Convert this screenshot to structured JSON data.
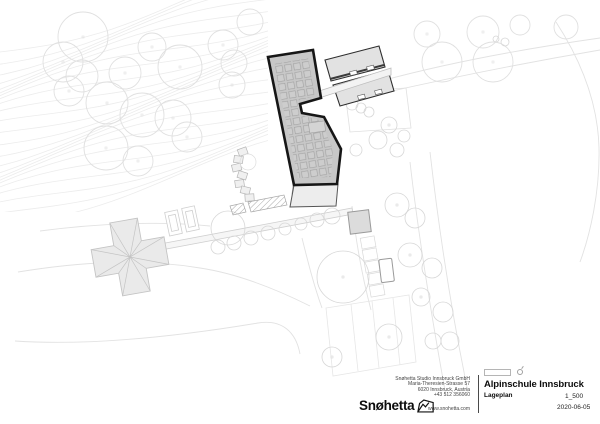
{
  "title_block": {
    "project": "Alpinschule Innsbruck",
    "drawing": "Lageplan",
    "scale": "1_500",
    "date": "2020-06-05",
    "firm": "Snøhetta",
    "address_lines": [
      "Snøhetta Studio Innsbruck GmbH",
      "Maria-Theresien-Strasse 57",
      "6020 Innsbruck, Austria",
      "+43 512 356060"
    ],
    "website": "www.snohetta.com"
  },
  "colors": {
    "background": "#ffffff",
    "contour": "#ececec",
    "road": "#e2e2e2",
    "tree": "#dfdfdf",
    "tree_small": "#d7d7d7",
    "light_fill": "#eaeaea",
    "light_stroke": "#c4c4c4",
    "roof_fill": "#c7c7c7",
    "outline_dark": "#161616",
    "barn_fill": "#e2e2e2",
    "gray": "#9a9a9a"
  },
  "plan": {
    "layers": [
      {
        "name": "contours",
        "stroke": "#ececec",
        "width": 0.8,
        "generator": {
          "count": 24,
          "spacing": 7.5,
          "base_y": 52,
          "slope": -0.28,
          "amp": 9,
          "wavelength": 58,
          "phase": 0.55,
          "x0": -20,
          "x1": 300,
          "step": 12
        }
      },
      {
        "name": "roads",
        "stroke": "#e2e2e2",
        "fill": "none",
        "width": 0.9,
        "items": [
          {
            "shape": "path",
            "d": "M340,93 C400,74 480,55 600,38"
          },
          {
            "shape": "path",
            "d": "M340,103 C420,84 500,67 600,50"
          },
          {
            "shape": "path",
            "d": "M556,22 C582,62 598,105 599,148 C600,192 590,235 580,262"
          },
          {
            "shape": "path",
            "d": "M430,152 C438,222 450,305 468,392"
          },
          {
            "shape": "path",
            "d": "M410,162 C418,232 430,308 446,396"
          },
          {
            "shape": "path",
            "d": "M18,272 C80,262 140,258 200,268 C240,274 282,292 310,306"
          },
          {
            "shape": "path",
            "d": "M15,341 C90,346 180,336 258,323 C282,319 296,332 300,354"
          },
          {
            "shape": "path",
            "d": "M302,238 C308,262 314,286 322,308"
          },
          {
            "shape": "path",
            "d": "M40,231 C100,223 160,221 210,226"
          },
          {
            "shape": "path",
            "d": "M352,206 C356,242 362,276 371,310"
          }
        ]
      },
      {
        "name": "parcel",
        "stroke": "#e6e6e6",
        "fill": "none",
        "width": 0.8,
        "items": [
          {
            "shape": "polygon",
            "points": "326,308 409,295 416,362 333,376"
          },
          {
            "shape": "line",
            "x1": 351,
            "y1": 304,
            "x2": 358,
            "y2": 371
          },
          {
            "shape": "line",
            "x1": 372,
            "y1": 301,
            "x2": 379,
            "y2": 368
          },
          {
            "shape": "line",
            "x1": 393,
            "y1": 298,
            "x2": 400,
            "y2": 365
          }
        ]
      },
      {
        "name": "trees-large",
        "stroke": "#e0e0e0",
        "fill": "none",
        "width": 0.9,
        "items": [
          {
            "shape": "circle",
            "x": 83,
            "y": 37,
            "r": 25,
            "dot": true
          },
          {
            "shape": "circle",
            "x": 63,
            "y": 62,
            "r": 20,
            "dot": true
          },
          {
            "shape": "circle",
            "x": 82,
            "y": 76,
            "r": 16
          },
          {
            "shape": "circle",
            "x": 69,
            "y": 91,
            "r": 15,
            "dot": true
          },
          {
            "shape": "circle",
            "x": 125,
            "y": 73,
            "r": 16,
            "dot": true
          },
          {
            "shape": "circle",
            "x": 107,
            "y": 103,
            "r": 21,
            "dot": true
          },
          {
            "shape": "circle",
            "x": 152,
            "y": 47,
            "r": 14,
            "dot": true
          },
          {
            "shape": "circle",
            "x": 180,
            "y": 67,
            "r": 22,
            "dot": true
          },
          {
            "shape": "circle",
            "x": 223,
            "y": 45,
            "r": 15,
            "dot": true
          },
          {
            "shape": "circle",
            "x": 234,
            "y": 63,
            "r": 13
          },
          {
            "shape": "circle",
            "x": 232,
            "y": 85,
            "r": 13,
            "dot": true
          },
          {
            "shape": "circle",
            "x": 142,
            "y": 115,
            "r": 22,
            "dot": true
          },
          {
            "shape": "circle",
            "x": 173,
            "y": 118,
            "r": 18,
            "dot": true
          },
          {
            "shape": "circle",
            "x": 187,
            "y": 137,
            "r": 15,
            "dot": true
          },
          {
            "shape": "circle",
            "x": 106,
            "y": 148,
            "r": 22,
            "dot": true
          },
          {
            "shape": "circle",
            "x": 138,
            "y": 161,
            "r": 15,
            "dot": true
          },
          {
            "shape": "circle",
            "x": 250,
            "y": 22,
            "r": 13
          },
          {
            "shape": "circle",
            "x": 427,
            "y": 34,
            "r": 13,
            "dot": true
          },
          {
            "shape": "circle",
            "x": 442,
            "y": 62,
            "r": 20,
            "dot": true
          },
          {
            "shape": "circle",
            "x": 483,
            "y": 32,
            "r": 16,
            "dot": true
          },
          {
            "shape": "circle",
            "x": 493,
            "y": 62,
            "r": 20,
            "dot": true
          },
          {
            "shape": "circle",
            "x": 520,
            "y": 25,
            "r": 10
          },
          {
            "shape": "circle",
            "x": 566,
            "y": 27,
            "r": 12
          }
        ]
      },
      {
        "name": "path-strip",
        "stroke": "#cfcfcf",
        "fill": "#f6f6f6",
        "width": 0.8,
        "items": [
          {
            "shape": "polygon",
            "points": "160,244 352,208 353,214 161,250"
          }
        ]
      },
      {
        "name": "chalet",
        "stroke": "#c4c4c4",
        "fill": "#eaeaea",
        "width": 0.9,
        "items": [
          {
            "shape": "polygon",
            "transform": "translate(130,257) rotate(-10)",
            "points": "-37,-14 -14,-14 -14,-37 14,-37 14,-14 37,-14 37,14 14,14 14,37 -14,37 -14,14 -37,14"
          },
          {
            "shape": "path",
            "transform": "translate(130,257) rotate(-10)",
            "fill": "none",
            "width": 0.7,
            "d": "M-37,-14L0,0L-14,-37M14,-37L0,0L37,-14M37,14L0,0L14,37M-14,37L0,0L-37,14M-14,-14L0,0L14,-14M14,14L0,0L-14,14"
          }
        ]
      },
      {
        "name": "drive-pads",
        "stroke": "#cfcfcf",
        "fill": "#ffffff",
        "width": 0.8,
        "items": [
          {
            "shape": "rect",
            "x": 167,
            "y": 211,
            "w": 13,
            "h": 24,
            "transform": "rotate(-12 173 223)"
          },
          {
            "shape": "rect",
            "x": 170,
            "y": 215,
            "w": 7,
            "h": 16,
            "fill": "none",
            "transform": "rotate(-12 173 223)"
          },
          {
            "shape": "rect",
            "x": 184,
            "y": 207,
            "w": 13,
            "h": 24,
            "transform": "rotate(-12 190 219)"
          },
          {
            "shape": "rect",
            "x": 187,
            "y": 211,
            "w": 7,
            "h": 16,
            "fill": "none",
            "transform": "rotate(-12 190 219)"
          }
        ]
      },
      {
        "name": "steps",
        "stroke": "#b5b5b5",
        "fill": "#f0f0f0",
        "width": 0.7,
        "items": [
          {
            "shape": "rect",
            "x": 238,
            "y": 148,
            "w": 9,
            "h": 7,
            "transform": "rotate(-20 243 151)"
          },
          {
            "shape": "rect",
            "x": 234,
            "y": 156,
            "w": 9,
            "h": 7,
            "transform": "rotate(8 239 159)"
          },
          {
            "shape": "rect",
            "x": 232,
            "y": 164,
            "w": 9,
            "h": 7,
            "transform": "rotate(-14 237 167)"
          },
          {
            "shape": "rect",
            "x": 238,
            "y": 172,
            "w": 9,
            "h": 7,
            "transform": "rotate(18 243 175)"
          },
          {
            "shape": "rect",
            "x": 235,
            "y": 180,
            "w": 9,
            "h": 7,
            "transform": "rotate(-8 240 183)"
          },
          {
            "shape": "rect",
            "x": 241,
            "y": 187,
            "w": 9,
            "h": 7,
            "transform": "rotate(14 246 190)"
          },
          {
            "shape": "rect",
            "x": 245,
            "y": 194,
            "w": 9,
            "h": 7,
            "transform": "rotate(-4 250 197)"
          },
          {
            "shape": "circle",
            "x": 248,
            "y": 162,
            "r": 8,
            "fill": "none",
            "stroke": "#dddddd"
          }
        ]
      },
      {
        "name": "stalls",
        "stroke": "#d8d8d8",
        "fill": "none",
        "width": 0.7,
        "items": [
          {
            "shape": "rect",
            "x": 361,
            "y": 237,
            "w": 14,
            "h": 11,
            "transform": "rotate(-10 368 242)"
          },
          {
            "shape": "rect",
            "x": 363,
            "y": 249,
            "w": 14,
            "h": 11,
            "transform": "rotate(-10 370 254)"
          },
          {
            "shape": "rect",
            "x": 365,
            "y": 261,
            "w": 14,
            "h": 11,
            "transform": "rotate(-10 372 266)"
          },
          {
            "shape": "rect",
            "x": 368,
            "y": 273,
            "w": 14,
            "h": 11,
            "transform": "rotate(-10 375 278)"
          },
          {
            "shape": "rect",
            "x": 370,
            "y": 285,
            "w": 14,
            "h": 11,
            "transform": "rotate(-10 377 290)"
          }
        ]
      },
      {
        "name": "outbuildings",
        "stroke": "#9a9a9a",
        "fill": "#dcdcdc",
        "width": 1,
        "items": [
          {
            "shape": "rect",
            "x": 349,
            "y": 211,
            "w": 21,
            "h": 22,
            "transform": "rotate(-7 359 222)"
          },
          {
            "shape": "rect",
            "x": 380,
            "y": 259,
            "w": 13,
            "h": 23,
            "rx": 1.5,
            "fill": "#ffffff",
            "transform": "rotate(-7 386 270)"
          },
          {
            "shape": "polygon",
            "points": "345,92 406,88 411,128 350,132",
            "fill": "none",
            "stroke": "#e0e0e0",
            "width": 0.8
          }
        ]
      },
      {
        "name": "trees-small",
        "stroke": "#d7d7d7",
        "fill": "none",
        "width": 0.8,
        "items": [
          {
            "shape": "circle",
            "x": 218,
            "y": 247,
            "r": 7
          },
          {
            "shape": "circle",
            "x": 234,
            "y": 243,
            "r": 7
          },
          {
            "shape": "circle",
            "x": 251,
            "y": 238,
            "r": 7
          },
          {
            "shape": "circle",
            "x": 268,
            "y": 233,
            "r": 7
          },
          {
            "shape": "circle",
            "x": 285,
            "y": 229,
            "r": 6
          },
          {
            "shape": "circle",
            "x": 301,
            "y": 224,
            "r": 6
          },
          {
            "shape": "circle",
            "x": 317,
            "y": 220,
            "r": 7
          },
          {
            "shape": "circle",
            "x": 332,
            "y": 216,
            "r": 8
          },
          {
            "shape": "circle",
            "x": 228,
            "y": 228,
            "r": 17
          },
          {
            "shape": "circle",
            "x": 397,
            "y": 205,
            "r": 12,
            "dot": true
          },
          {
            "shape": "circle",
            "x": 415,
            "y": 218,
            "r": 10
          },
          {
            "shape": "circle",
            "x": 410,
            "y": 255,
            "r": 12,
            "dot": true
          },
          {
            "shape": "circle",
            "x": 432,
            "y": 268,
            "r": 10
          },
          {
            "shape": "circle",
            "x": 421,
            "y": 297,
            "r": 9,
            "dot": true
          },
          {
            "shape": "circle",
            "x": 443,
            "y": 312,
            "r": 10
          },
          {
            "shape": "circle",
            "x": 433,
            "y": 341,
            "r": 8
          },
          {
            "shape": "circle",
            "x": 450,
            "y": 341,
            "r": 9
          },
          {
            "shape": "circle",
            "x": 389,
            "y": 337,
            "r": 13,
            "dot": true
          },
          {
            "shape": "circle",
            "x": 332,
            "y": 357,
            "r": 10,
            "dot": true
          },
          {
            "shape": "circle",
            "x": 343,
            "y": 277,
            "r": 26,
            "dot": true
          },
          {
            "shape": "circle",
            "x": 352,
            "y": 104,
            "r": 6
          },
          {
            "shape": "circle",
            "x": 361,
            "y": 108,
            "r": 5
          },
          {
            "shape": "circle",
            "x": 369,
            "y": 112,
            "r": 5
          },
          {
            "shape": "circle",
            "x": 389,
            "y": 125,
            "r": 8,
            "dot": true
          },
          {
            "shape": "circle",
            "x": 378,
            "y": 140,
            "r": 9
          },
          {
            "shape": "circle",
            "x": 397,
            "y": 150,
            "r": 7
          },
          {
            "shape": "circle",
            "x": 356,
            "y": 150,
            "r": 6
          },
          {
            "shape": "circle",
            "x": 404,
            "y": 136,
            "r": 6
          },
          {
            "shape": "circle",
            "x": 505,
            "y": 42,
            "r": 4
          },
          {
            "shape": "circle",
            "x": 496,
            "y": 39,
            "r": 3
          }
        ]
      },
      {
        "name": "hatch-strips",
        "stroke": "#a8a8a8",
        "fill": "url(#hatch)",
        "width": 0.7,
        "items": [
          {
            "shape": "polygon",
            "points": "248,202 284,195 287,205 251,212"
          },
          {
            "shape": "polygon",
            "points": "230,206 243,203 246,212 233,215"
          },
          {
            "shape": "polygon",
            "points": "293,186 337,185 336,193 292,194"
          }
        ]
      },
      {
        "name": "barns",
        "stroke": "#2e2e2e",
        "fill": "#e2e2e2",
        "width": 1.1,
        "items": [
          {
            "shape": "polygon",
            "points": "325,60 379,46 385,67 331,81"
          },
          {
            "shape": "polygon",
            "points": "333,85 388,70 394,91 340,106"
          },
          {
            "shape": "line",
            "x1": 330,
            "y1": 79,
            "x2": 384,
            "y2": 65,
            "width": 2,
            "stroke": "#3a3a3a"
          },
          {
            "shape": "line",
            "x1": 336,
            "y1": 89,
            "x2": 390,
            "y2": 74,
            "width": 2,
            "stroke": "#3a3a3a"
          },
          {
            "shape": "rect",
            "x": 350,
            "y": 71,
            "w": 7,
            "h": 4,
            "fill": "#ffffff",
            "stroke": "#555555",
            "width": 0.6,
            "transform": "rotate(-14 353 73)"
          },
          {
            "shape": "rect",
            "x": 367,
            "y": 66,
            "w": 7,
            "h": 4,
            "fill": "#ffffff",
            "stroke": "#555555",
            "width": 0.6,
            "transform": "rotate(-14 370 68)"
          },
          {
            "shape": "rect",
            "x": 358,
            "y": 95,
            "w": 7,
            "h": 4,
            "fill": "#ffffff",
            "stroke": "#555555",
            "width": 0.6,
            "transform": "rotate(-14 361 97)"
          },
          {
            "shape": "rect",
            "x": 375,
            "y": 90,
            "w": 7,
            "h": 4,
            "fill": "#ffffff",
            "stroke": "#555555",
            "width": 0.6,
            "transform": "rotate(-14 378 92)"
          },
          {
            "shape": "polygon",
            "points": "316,92 391,68 391,75 316,99",
            "fill": "#f3f3f3",
            "stroke": "#bdbdbd",
            "width": 0.8
          }
        ]
      },
      {
        "name": "main-building",
        "stroke": "#161616",
        "fill": "#c7c7c7",
        "width": 2.6,
        "items": [
          {
            "shape": "polygon",
            "points": "294,185 338,184 336,206 290,207",
            "fill": "#ededed",
            "stroke": "#555555",
            "width": 1
          },
          {
            "shape": "polygon",
            "points": "268,57 313,50 321,98 300,104 302,113 324,117 341,149 337,184 294,185"
          },
          {
            "shape": "polygon",
            "points": "274,64 308,58 315,96 297,101 299,115 320,120 333,149 331,177 298,178",
            "fill": "url(#panels)",
            "stroke": "none"
          },
          {
            "shape": "rect",
            "x": 309,
            "y": 122,
            "w": 16,
            "h": 10,
            "fill": "#d4d4d4",
            "stroke": "#9e9e9e",
            "width": 0.6,
            "transform": "rotate(-8 317 127)"
          }
        ]
      }
    ]
  }
}
